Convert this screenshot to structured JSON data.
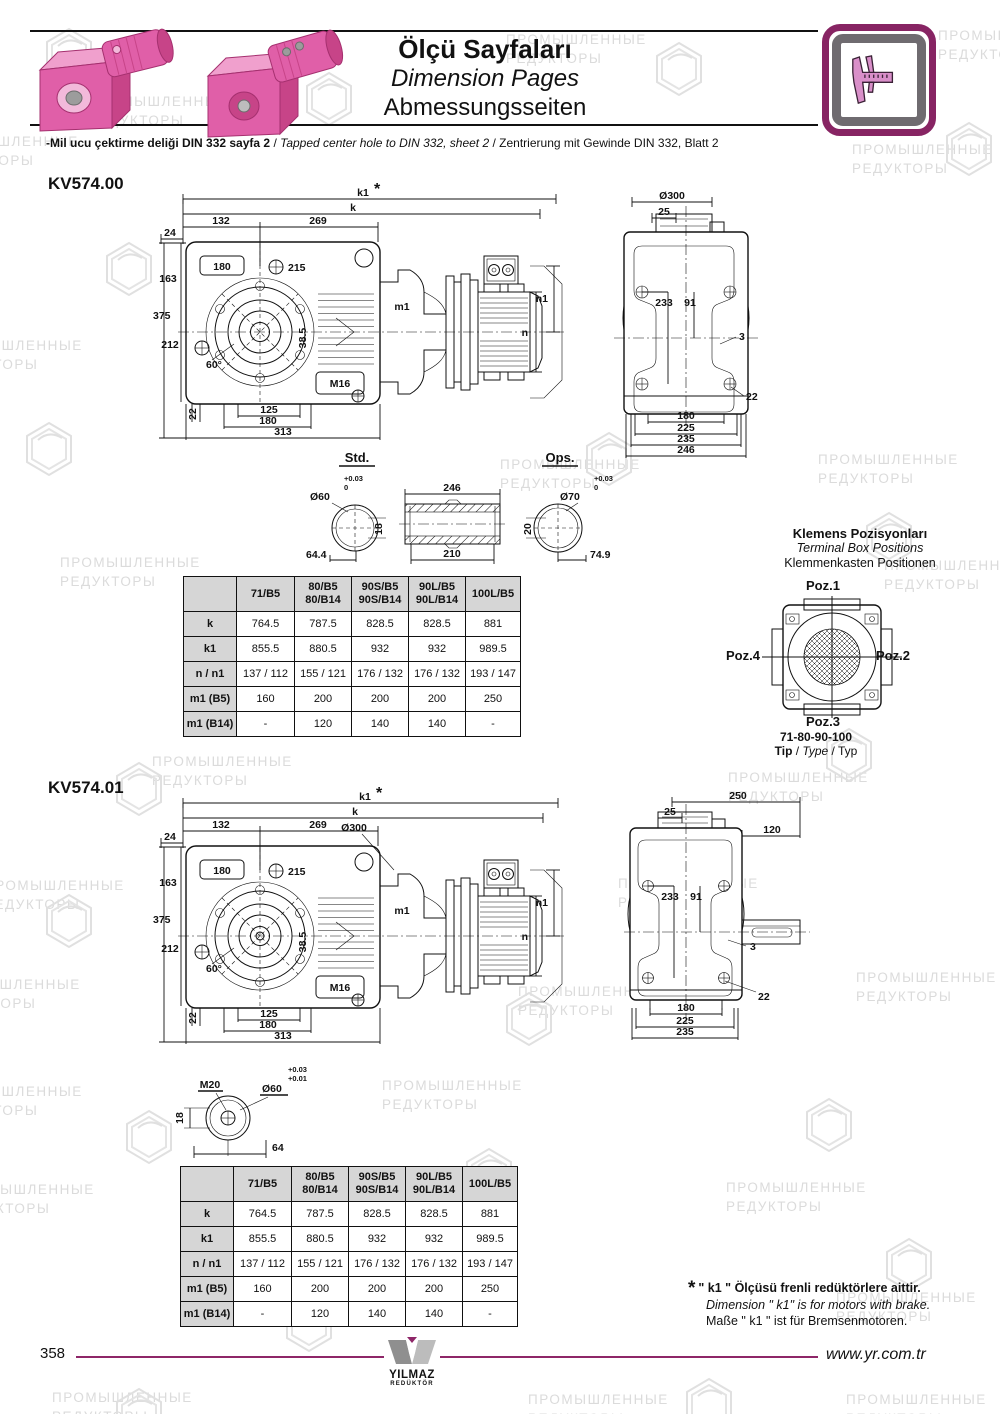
{
  "header": {
    "title_tr": "Ölçü Sayfaları",
    "title_en": "Dimension Pages",
    "title_de": "Abmessungsseiten",
    "subtitle_tr": "-Mil ucu çektirme deliği DIN 332 sayfa 2",
    "subtitle_sep1": "/",
    "subtitle_en": "Tapped center hole to DIN 332, sheet 2",
    "subtitle_sep2": "/",
    "subtitle_de": "Zentrierung mit Gewinde DIN 332, Blatt 2",
    "caliper_icon": "caliper-icon",
    "product_image": "pink-gearmotors"
  },
  "kv00": {
    "code": "KV574.00",
    "main": {
      "k1": "k1",
      "star": "*",
      "k": "k",
      "d132": "132",
      "d269": "269",
      "d24": "24",
      "d180": "180",
      "d215": "215",
      "d163": "163",
      "d375": "375",
      "d212": "212",
      "d60": "60°",
      "m16": "M16",
      "d385": "38.5",
      "d22": "22",
      "d125": "125",
      "d180b": "180",
      "d313": "313",
      "m1": "m1",
      "n": "n",
      "n1": "n1"
    },
    "side": {
      "d300": "Ø300",
      "d25": "25",
      "d233": "233",
      "d91": "91",
      "d3": "3",
      "d22": "22",
      "d180": "180",
      "d225": "225",
      "d235": "235",
      "d246": "246"
    }
  },
  "shafts": {
    "std_label": "Std.",
    "ops_label": "Ops.",
    "std": {
      "dia": "Ø60",
      "tol_hi": "+0.03",
      "tol_lo": "0",
      "key": "18",
      "len": "64.4"
    },
    "sleeve": {
      "outer": "246",
      "inner": "210"
    },
    "ops": {
      "dia": "Ø70",
      "tol_hi": "+0.03",
      "tol_lo": "0",
      "key": "20",
      "len": "74.9"
    }
  },
  "terminal_box": {
    "title_tr": "Klemens Pozisyonları",
    "title_en": "Terminal Box Positions",
    "title_de": "Klemmenkasten Positionen",
    "poz1": "Poz.1",
    "poz2": "Poz.2",
    "poz3": "Poz.3",
    "poz4": "Poz.4",
    "types": "71-80-90-100",
    "tip_tr": "Tip",
    "tip_en": "Type",
    "tip_de": "Typ"
  },
  "dimension_table": {
    "columns": [
      "",
      "71/B5",
      "80/B5\n80/B14",
      "90S/B5\n90S/B14",
      "90L/B5\n90L/B14",
      "100L/B5"
    ],
    "rows": [
      {
        "label": "k",
        "values": [
          "764.5",
          "787.5",
          "828.5",
          "828.5",
          "881"
        ]
      },
      {
        "label": "k1",
        "values": [
          "855.5",
          "880.5",
          "932",
          "932",
          "989.5"
        ]
      },
      {
        "label": "n / n1",
        "values": [
          "137 / 112",
          "155 / 121",
          "176 / 132",
          "176 / 132",
          "193 / 147"
        ]
      },
      {
        "label": "m1 (B5)",
        "values": [
          "160",
          "200",
          "200",
          "200",
          "250"
        ]
      },
      {
        "label": "m1 (B14)",
        "values": [
          "-",
          "120",
          "140",
          "140",
          "-"
        ]
      }
    ]
  },
  "kv01": {
    "code": "KV574.01",
    "main": {
      "k1": "k1",
      "star": "*",
      "k": "k",
      "d132": "132",
      "d269": "269",
      "d24": "24",
      "d300": "Ø300",
      "d180": "180",
      "d215": "215",
      "d163": "163",
      "d375": "375",
      "d212": "212",
      "d60": "60°",
      "m16": "M16",
      "d385": "38.5",
      "d22": "22",
      "d125": "125",
      "d180b": "180",
      "d313": "313",
      "m1": "m1",
      "n": "n",
      "n1": "n1"
    },
    "side": {
      "d250": "250",
      "d25": "25",
      "d120": "120",
      "d233": "233",
      "d91": "91",
      "d3": "3",
      "d22": "22",
      "d180": "180",
      "d225": "225",
      "d235": "235"
    },
    "shaft_detail": {
      "m20": "M20",
      "tol_hi": "+0.03",
      "tol_lo": "+0.01",
      "dia": "Ø60",
      "key": "18",
      "len": "64"
    }
  },
  "footnote": {
    "star": "*",
    "line_tr": "\" k1 \" Ölçüsü frenli redüktörlere aittir.",
    "line_en": "Dimension \" k1\" is for motors with brake.",
    "line_de": "Maße \" k1 \" ist für Bremsenmotoren."
  },
  "footer": {
    "page": "358",
    "logo_name": "YILMAZ",
    "logo_sub": "REDÜKTÖR",
    "website": "www.yr.com.tr"
  },
  "watermark": {
    "line1": "ПРОМЫШЛЕННЫЕ",
    "line2": "РЕДУКТОРЫ"
  },
  "colors": {
    "accent_pink": "#e05fa8",
    "frame_purple": "#872463",
    "footer_purple": "#8e2668",
    "table_header_bg": "#d6d6d6",
    "watermark_gray": "#dbdbdb"
  }
}
